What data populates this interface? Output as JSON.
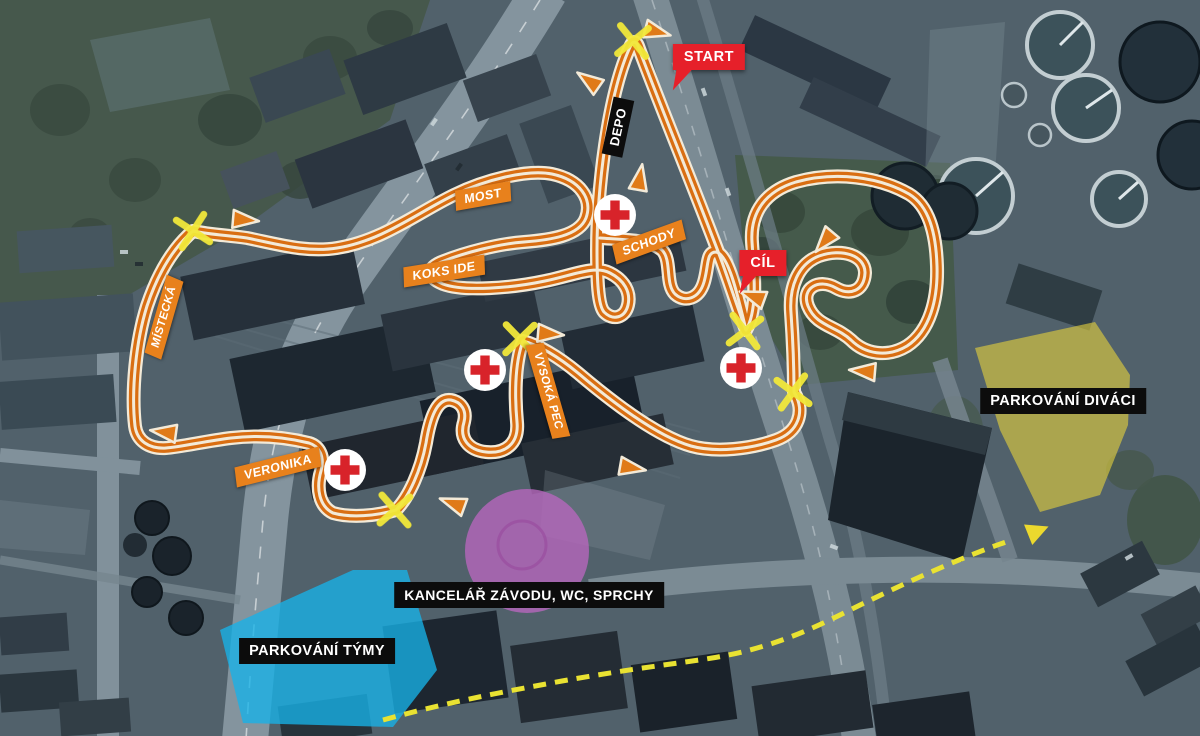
{
  "map": {
    "kind": "race-course-aerial-map",
    "labels": {
      "start": "START",
      "finish": "CÍL",
      "depo": "DEPO",
      "most": "MOST",
      "schody": "SCHODY",
      "koks_ide": "KOKS IDE",
      "mistecka": "MÍSTECKÁ",
      "vysoka_pec": "VYSOKÁ PEC",
      "veronika": "VERONIKA",
      "parking_spectators": "PARKOVÁNÍ DIVÁCI",
      "parking_teams": "PARKOVÁNÍ TÝMY",
      "race_office": "KANCELÁŘ ZÁVODU, WC, SPRCHY"
    },
    "icons": {
      "first_aid": "red-cross-in-white-circle",
      "crossing": "yellow-x-mark",
      "direction": "orange-triangle-arrow",
      "first_aid_count": 4,
      "crossing_count": 6
    },
    "colors": {
      "track_orange": "#d96e12",
      "track_edge_cream": "#f3ead8",
      "label_orange": "#e8811c",
      "label_black": "#0c0c0c",
      "flag_red": "#e6202a",
      "first_aid_red": "#d8232a",
      "crossing_yellow": "#f2e83a",
      "team_parking_blue": "#17b2e8",
      "spectator_parking_yellow": "#e2ce3e",
      "office_purple": "#b566bb",
      "walk_path_yellow": "#e9e232"
    }
  }
}
